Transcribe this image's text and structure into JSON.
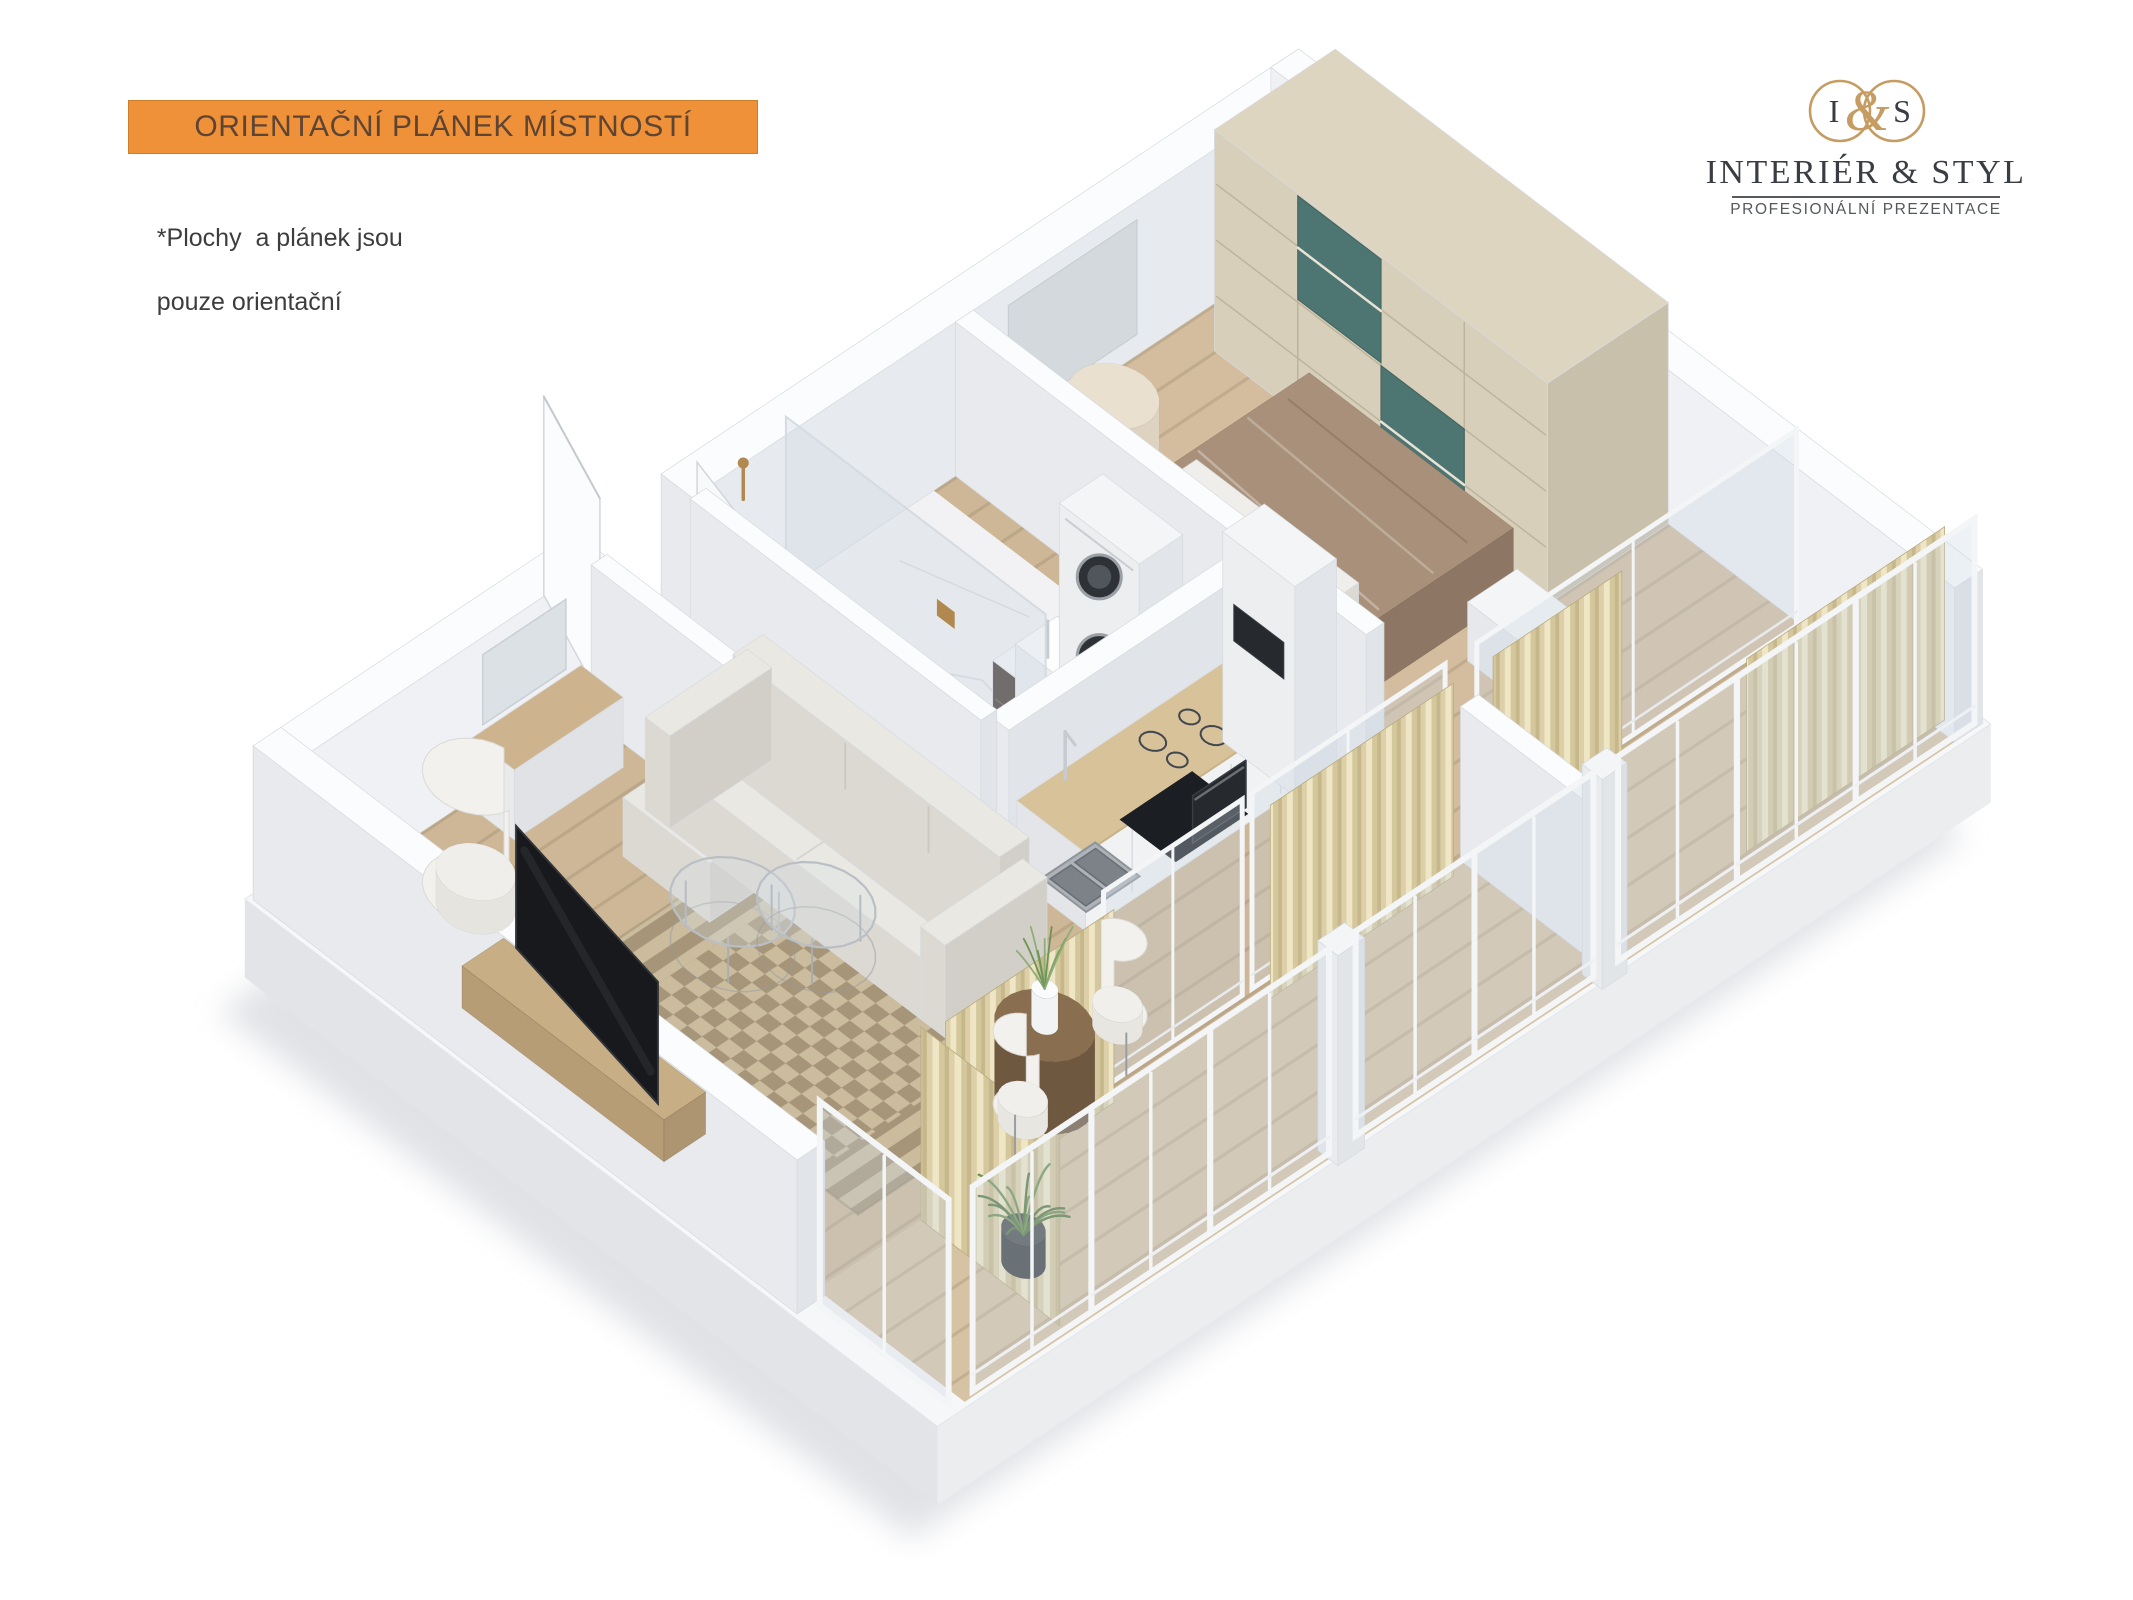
{
  "banner": {
    "label": "ORIENTAČNÍ PLÁNEK MÍSTNOSTÍ",
    "bg": "#ee9139",
    "text_color": "#5e4433"
  },
  "disclaimer": {
    "line1": "*Plochy  a plánek jsou",
    "line2": "pouze orientační",
    "color": "#3d3d3d"
  },
  "logo": {
    "monogram_left": "I",
    "monogram_right": "S",
    "ampersand": "&",
    "title": "INTERIÉR & STYL",
    "subtitle": "PROFESIONÁLNÍ PREZENTACE",
    "gold": "#c69c62",
    "dark": "#3a3d43",
    "rule_color": "#55585c"
  },
  "floorplan": {
    "colors": {
      "slab_top": "#f6f7f8",
      "slab_sw": "#e2e4e7",
      "slab_se": "#ebedef",
      "shadow": "#c8cbd1",
      "wall_top": "#fbfcfd",
      "wall_sw": "#e8eaed",
      "wall_se": "#e1e4e8",
      "wall_inner": "#eff1f4",
      "wall_inner_dim": "#e7eaee",
      "wall_stroke": "#d7dade",
      "wood_living": "#cdb797",
      "wood_hall": "#dfcfb1",
      "wood_bedroom": "#d3bd9e",
      "wood_loggia": "#d6c3a4",
      "plank_line": "rgba(96,76,48,0.16)",
      "marble": "#f2f2f4",
      "marble_vein": "#d9dadd",
      "rug_base": "#cbbc9e",
      "rug_border": "#b3a283",
      "rug_motif": "rgba(122,102,76,0.45)",
      "teal": "#4d7571",
      "teal_dark": "#3c5f5b",
      "teal_light": "#7fa19c",
      "counter_wood": "#d8c29a",
      "cabinet": "#f1f2f4",
      "cabinet_shade": "#e3e5e9",
      "dark_appliance": "#1b1e22",
      "appliance_ring": "#41474e",
      "steel": "#aeb3b8",
      "steel_dark": "#7c8288",
      "sofa": "#eae8e3",
      "sofa_sw": "#dcd9d2",
      "sofa_se": "#d2cfc8",
      "duvet": "#a9907a",
      "duvet_sw": "#97806c",
      "duvet_se": "#8d7663",
      "pillow": "#f0eeea",
      "bedframe": "#f1f0ee",
      "wardrobe_top": "#ded5c1",
      "wardrobe_front": "#d8cfba",
      "wardrobe_side": "#c9c0ab",
      "wardrobe_line": "#bdb49e",
      "curtain_a": "#efe6c6",
      "curtain_b": "#d5c79c",
      "curtain_c": "#c7b88c",
      "curtain_d": "#ddd0a8",
      "curtain_base": "#e6dab6",
      "glass": "rgba(203,216,226,0.32)",
      "glass_stroke": "#d5dbe0",
      "frame": "#f3f5f7",
      "tv": "#17191c",
      "tv_edge": "#303337",
      "wood_dark": "#8a6e50",
      "wood_dark_side": "#6f5840",
      "vanity_dark": "#473c34",
      "vanity_dark2": "#5a4c41",
      "mat_dark": "#4a423b",
      "gold": "#b08850",
      "white_obj": "#f4f5f6",
      "plant": "#6d9355",
      "plant_dark": "#577a42",
      "lamp_glow": "#f8edb0",
      "lamp_body": "#efe6ae"
    },
    "elements": [
      "floor-shadow",
      "base-slab",
      "living-floor",
      "hall-floor",
      "bathroom-floor",
      "bedroom-floor",
      "loggia-floor",
      "entry-threshold",
      "living-rug",
      "bedroom-runner-rug",
      "wall-nw-living",
      "wall-nw-bedroom",
      "bedroom-wall-niche",
      "wall-sw",
      "wall-ne",
      "entry-door-left-leaf",
      "entry-door-right-leaf",
      "wardrobe",
      "pouf",
      "bedside-lamp",
      "bed",
      "nightstand",
      "bedroom-divider-wall",
      "shower-mat",
      "bathroom-vanity",
      "washer-dryer-stack",
      "shower-glass-panel",
      "shower-fixture",
      "bathroom-block-wall",
      "hall-wall-left",
      "hall-wall-right",
      "kitchen-counter",
      "kitchen-sink",
      "induction-cooktop",
      "built-in-oven",
      "fridge-column",
      "wall-mirror",
      "entry-sideboard",
      "sofa",
      "coffee-table-1",
      "coffee-table-2",
      "egg-chair",
      "tv-cabinet",
      "tv-screen",
      "partition-glass-doors",
      "curtain-living",
      "curtain-sw-side",
      "curtain-kitchen",
      "curtain-bedroom",
      "curtain-bedroom-window",
      "loggia-divider-wall",
      "dining-table",
      "dining-plant",
      "dining-chair-1",
      "dining-chair-2",
      "corner-plant",
      "facade-windows",
      "window-post-1",
      "window-post-2",
      "sw-window"
    ]
  }
}
